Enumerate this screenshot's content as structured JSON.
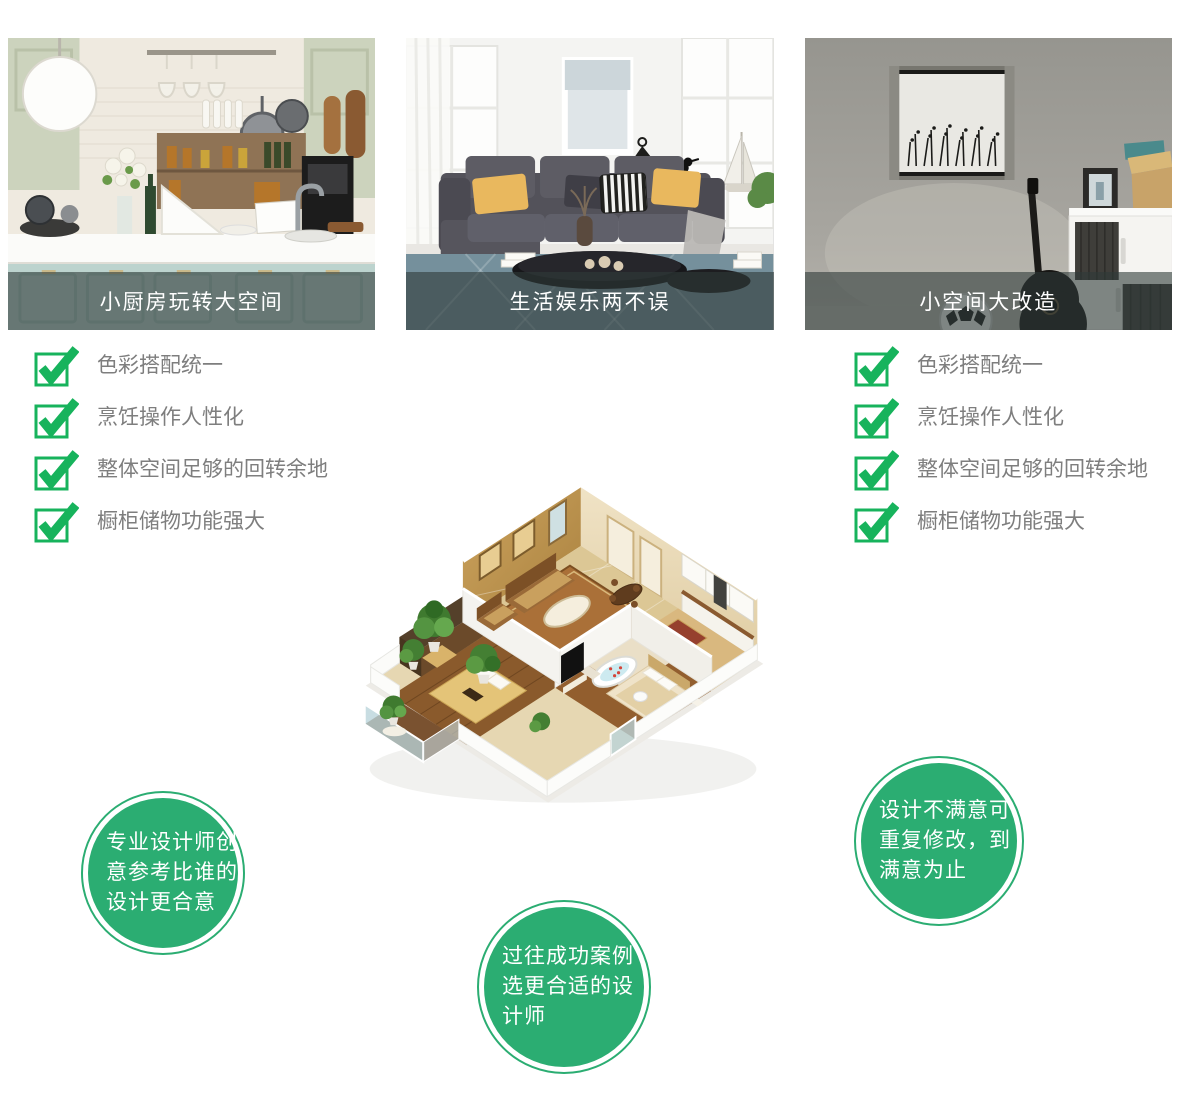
{
  "colors": {
    "badge_green": "#2bad72",
    "check_green": "#17b35c",
    "caption_bg": "rgba(47,58,56,0.60)",
    "checklist_text": "#7e7e7e",
    "caption_text": "#ffffff"
  },
  "cards": [
    {
      "caption": "小厨房玩转大空间"
    },
    {
      "caption": "生活娱乐两不误"
    },
    {
      "caption": "小空间大改造"
    }
  ],
  "checklist": {
    "items": [
      "色彩搭配统一",
      "烹饪操作人性化",
      "整体空间足够的回转余地",
      "橱柜储物功能强大"
    ]
  },
  "badges": [
    {
      "lines": [
        "专业设计师创",
        "意参考比谁的",
        "设计更合意"
      ]
    },
    {
      "lines": [
        "过往成功案例",
        "选更合适的设",
        "计师"
      ]
    },
    {
      "lines": [
        "设计不满意可",
        "重复修改，到",
        "满意为止"
      ]
    }
  ]
}
